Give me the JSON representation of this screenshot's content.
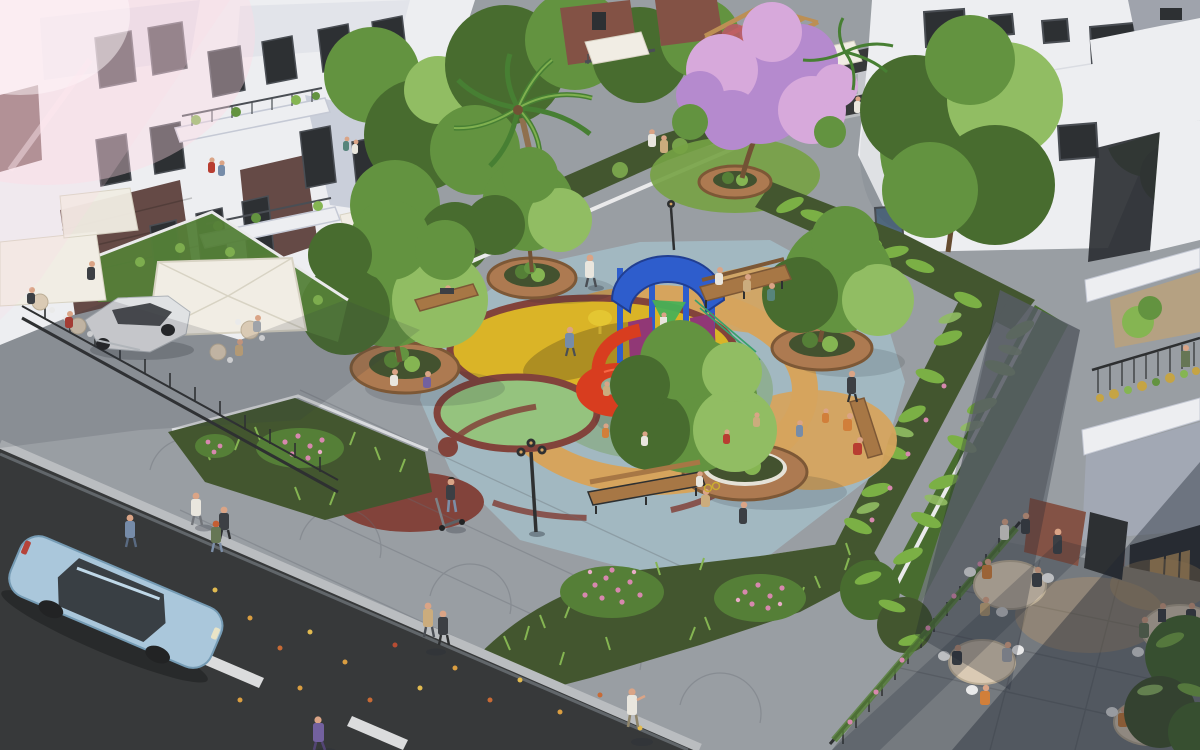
{
  "image": {
    "type": "3d-architectural-render",
    "view": "aerial-oblique",
    "setting": "Residential townhouse complex with central children's playground park, street cafes, pedestrians and cars at golden hour",
    "time_of_day": "golden-hour"
  },
  "objects": {
    "buildings": [
      "townhouse-row-left",
      "white-apartment-top-right",
      "shophouse-right"
    ],
    "park_features": [
      "circular-tree-planters",
      "play-structure",
      "spiral-slide",
      "colored-rubber-circles",
      "flower-beds",
      "palm-tree",
      "purple-blossom-tree",
      "banana-hedges",
      "wood-benches",
      "ornate-lamp-posts"
    ],
    "planter_count": 5,
    "bench_count": 4,
    "lamp_count": 2,
    "vehicles": [
      "blue-sedan-street",
      "white-sedan-parked",
      "silver-sports-car-top"
    ],
    "cafe_terraces": 2,
    "umbrella_count": 6
  },
  "palette": {
    "flare_pink": "#ffd9e6",
    "sun_warm": "#ffe9c9",
    "facade_white": "#edeff4",
    "facade_shade": "#ccd2e0",
    "facade_blue_shade": "#aab3c9",
    "brick_dark": "#5d4240",
    "brick_red": "#7d4a3f",
    "window_dark": "#22262c",
    "window_frame": "#41464e",
    "glass_warm": "#cf9f5c",
    "roof_gray": "#9aa0ab",
    "plaza_paver": "#949aa2",
    "sidewalk_dark": "#6e747c",
    "asphalt": "#2d3033",
    "curb_light": "#b7bbc0",
    "lane_white": "#e9ebee",
    "park_surface_blue": "#9db6c1",
    "teal_circle": "#8aab92",
    "yellow_circle": "#d8b11f",
    "green_circle": "#90c17b",
    "maroon_circle": "#7c3a34",
    "orange_surface": "#d4a158",
    "wood_deck": "#a9744b",
    "wood_dark": "#77512f",
    "planter_soil": "#394a28",
    "shrub_green": "#4c7a30",
    "leaf_light": "#7fb34c",
    "tree_dark": "#3f6628",
    "tree_mid": "#5b8f39",
    "tree_light": "#8cbb5e",
    "palm_green": "#3e7a2c",
    "banana_green": "#74ad3f",
    "grass_green": "#6f9f3d",
    "hedge_dark": "#394f28",
    "purple_bloom": "#b285cf",
    "purple_bloom_light": "#d5a6dd",
    "flower_pink": "#d583ad",
    "bloom_red": "#bb4f62",
    "pergola_wood": "#b98b4e",
    "play_blue": "#2356cd",
    "play_red": "#d63417",
    "play_purple": "#8c2f72",
    "play_yellow": "#e3c52b",
    "play_green": "#3fae52",
    "bench_wood": "#a3713f",
    "metal_dark": "#23262a",
    "umbrella_white": "#f1eee6",
    "umbrella_shade": "#d6d2c4",
    "table_beige": "#d9c9b4",
    "chair_white": "#e9eaec",
    "car_blue": "#a6c6dd",
    "car_blue_dark": "#6e97b4",
    "car_white": "#dfe2e6",
    "car_silver": "#c3c9d2",
    "tire_dark": "#17191c",
    "skin": "#d9a183",
    "shadow_blue": "#1d2531",
    "p_white": "#e8e6e0",
    "p_dark": "#32363e",
    "p_blue": "#6f87a8",
    "p_orange": "#cf7a33",
    "p_red": "#b5342a",
    "p_green": "#5e7050",
    "p_tan": "#c9a97a",
    "p_purple": "#6c5a9e",
    "p_gray": "#9aa0a8",
    "p_teal": "#4f7f78"
  }
}
